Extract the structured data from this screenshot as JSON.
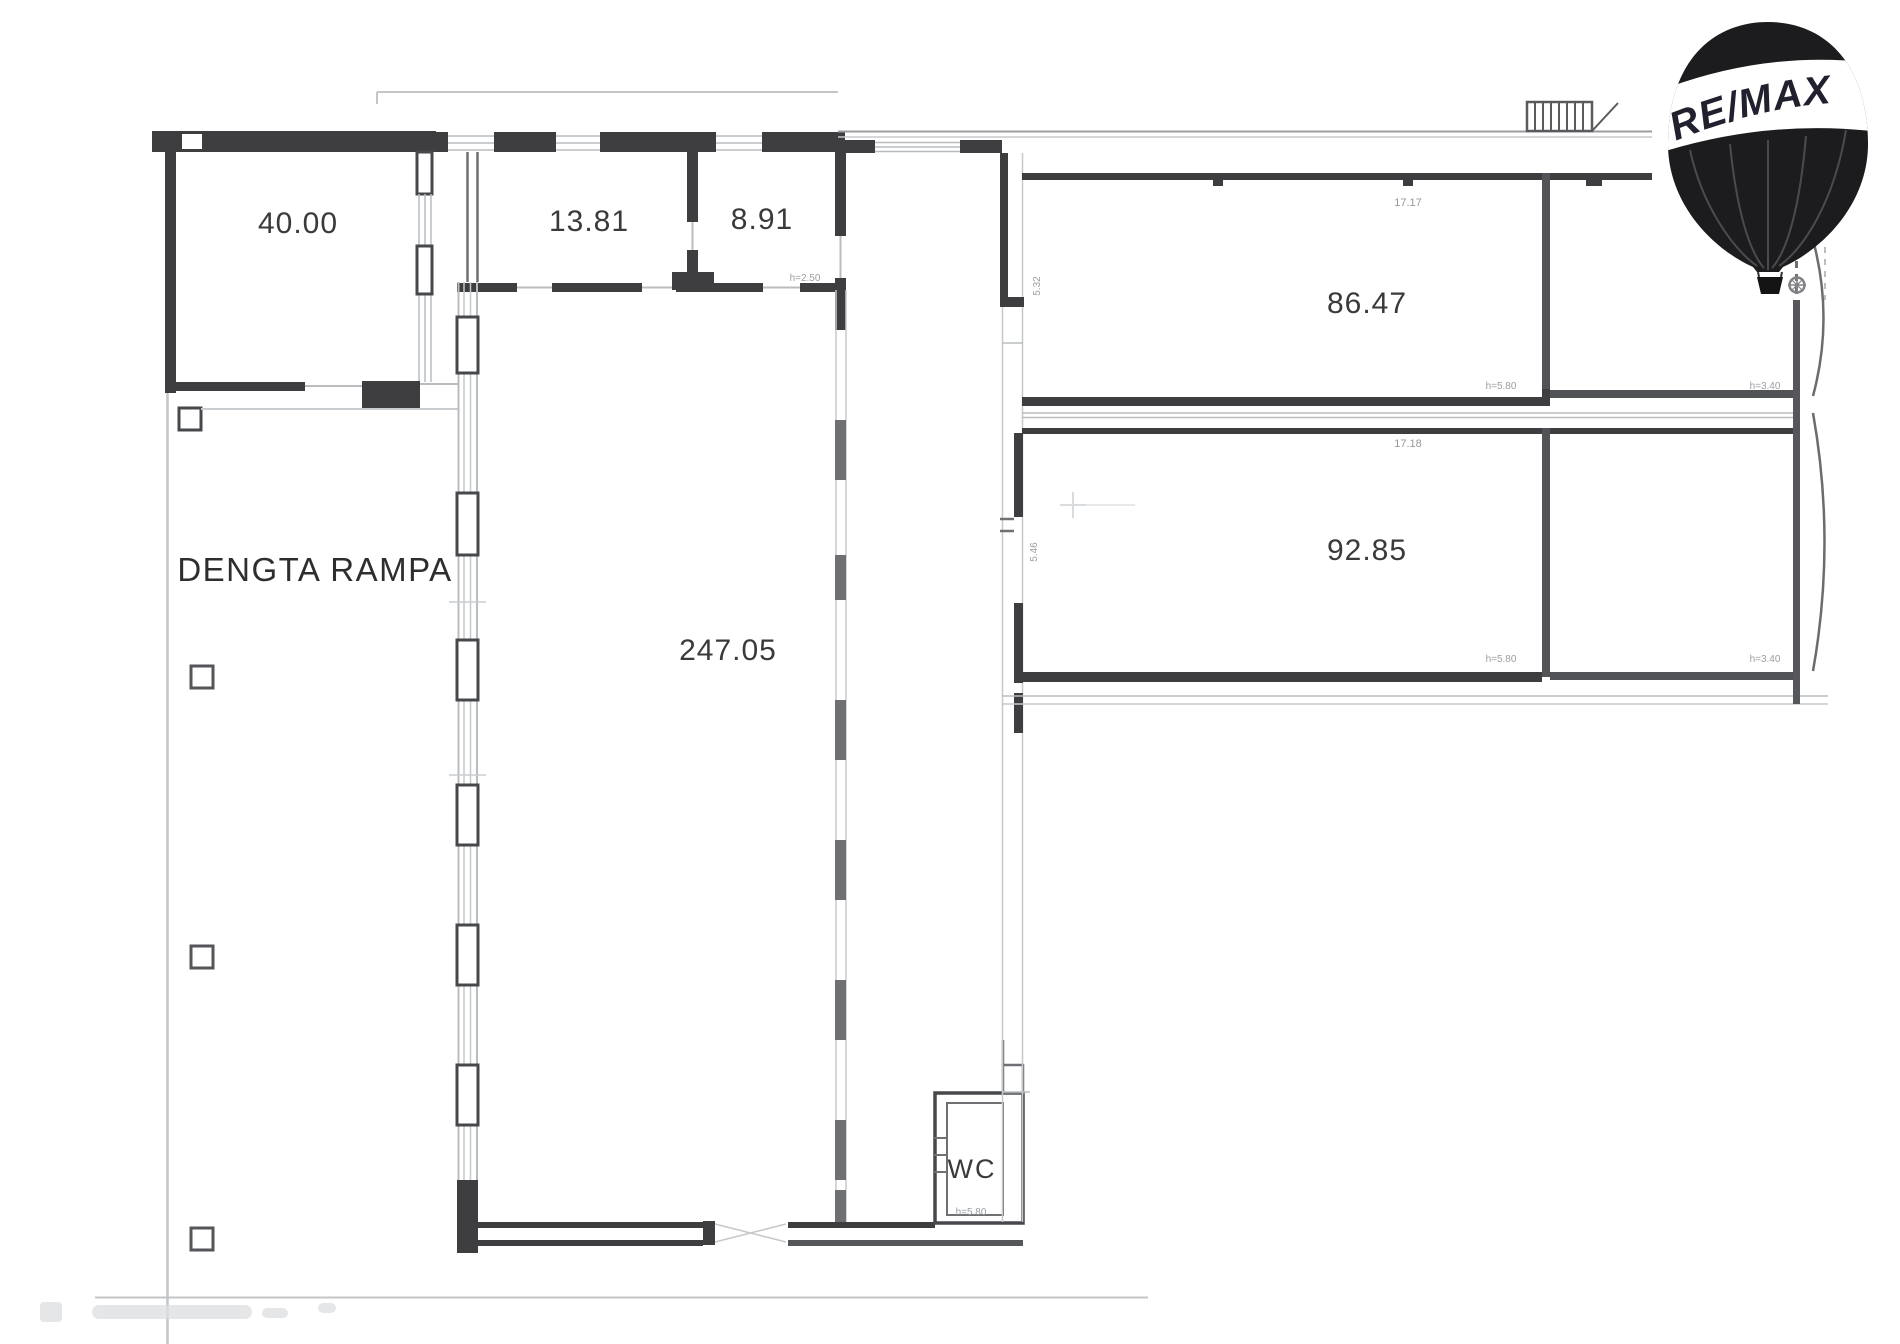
{
  "logo": {
    "brand": "RE/MAX"
  },
  "plan": {
    "site_label": "DENGTA RAMPA",
    "rooms": {
      "storage": "40.00",
      "office_a": "13.81",
      "office_b": "8.91",
      "hall": "247.05",
      "unit_upper": "86.47",
      "unit_lower": "92.85",
      "wc": "WC"
    },
    "dimensions": {
      "office_b_height": "h=2.50",
      "unit_upper_width": "17.17",
      "unit_lower_width": "17.18",
      "unit_upper_depth": "5.32",
      "unit_lower_depth": "5.46",
      "height_580": "h=5.80",
      "height_340": "h=3.40",
      "wc_height": "h=5.80"
    }
  }
}
